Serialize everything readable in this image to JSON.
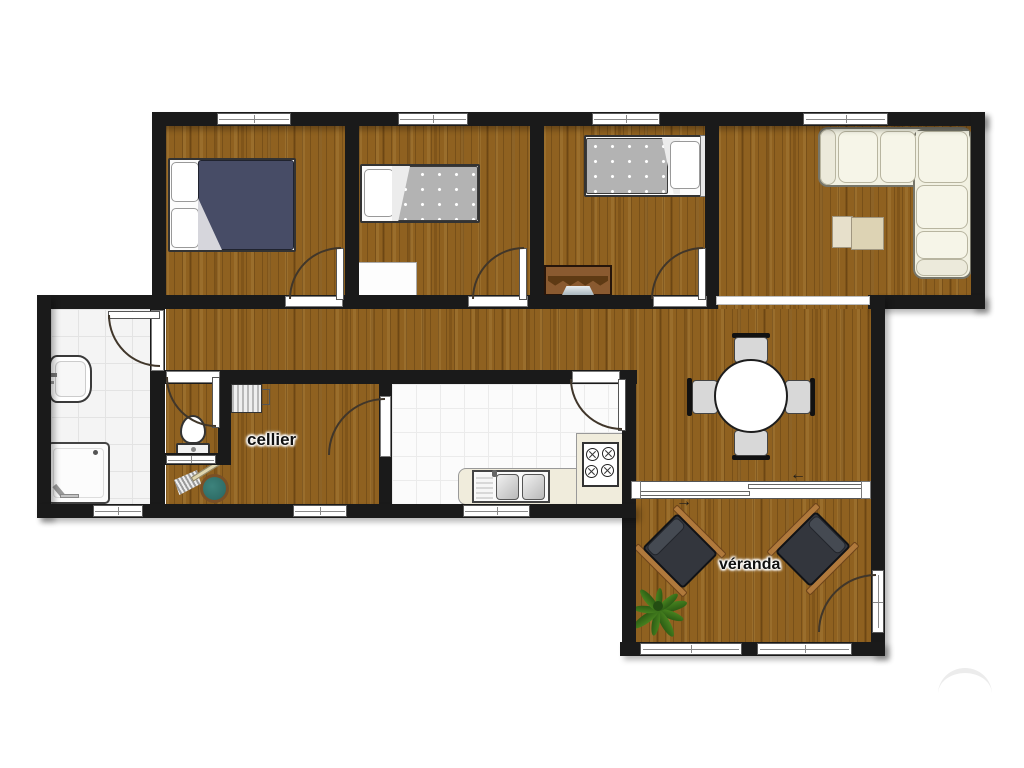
{
  "labels": {
    "cellier": "cellier",
    "veranda": "véranda"
  },
  "sliding_door": {
    "arrow_upper": "←",
    "arrow_lower": "→"
  },
  "palette": {
    "wall": "#1a1a1a",
    "wood": "#8f6120",
    "kitchen_tile": "#fbfbfb",
    "bath_tile": "#f4f4f4",
    "sofa": "#f2f1e2",
    "bed_navy": "#474c66",
    "bed_gray": "#b3b3b3",
    "chair_gray": "#d8d8d8",
    "armchair_dark": "#33363d",
    "armrest_wood": "#b0793c",
    "plant_green": "#47821f",
    "counter_cream": "#f0ecdc",
    "bucket_teal": "#2f6e68"
  }
}
